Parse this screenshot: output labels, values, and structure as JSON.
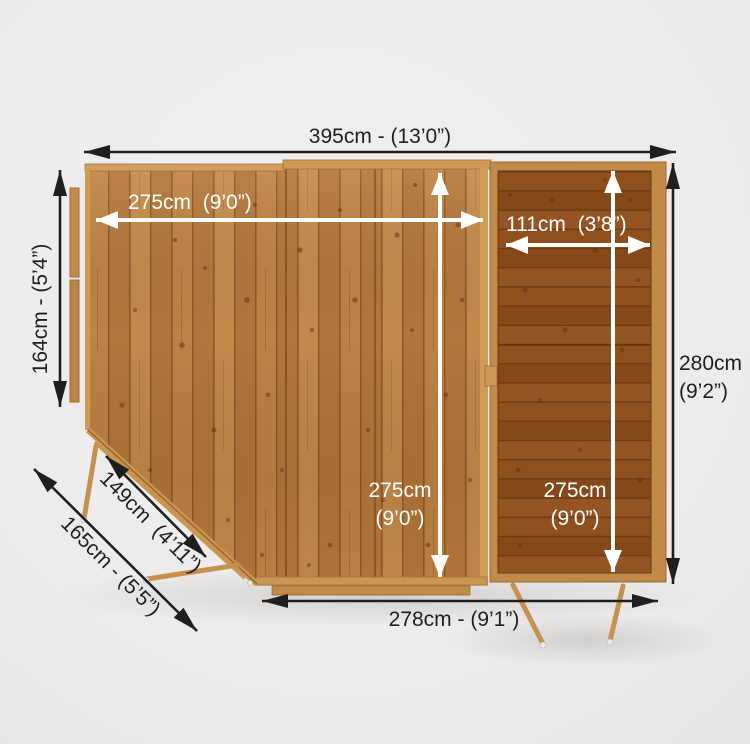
{
  "diagram": {
    "dimensions": {
      "top": "395cm - (13’0”)",
      "main_width": "275cm  (9’0”)",
      "shed_width": "111cm  (3’8”)",
      "left": "164cm - (5’4”)",
      "right": {
        "l1": "280cm",
        "l2": "(9’2”)"
      },
      "main_depth": {
        "l1": "275cm",
        "l2": "(9’0”)"
      },
      "shed_depth": {
        "l1": "275cm",
        "l2": "(9’0”)"
      },
      "corner_inner": "149cm  (4’11”)",
      "corner_outer": "165cm - (5’5”)",
      "bottom": "278cm - (9’1”)"
    },
    "colors": {
      "bg": "#ecebea",
      "ink": "#1f1f1f",
      "label-white": "#ffffff",
      "wood-main": "#b87c3f",
      "wood-dark": "#8c4d1c",
      "wood-frame": "#c28a49",
      "wood-trim": "#d2a05e",
      "metal": "#e9e9e9"
    }
  }
}
